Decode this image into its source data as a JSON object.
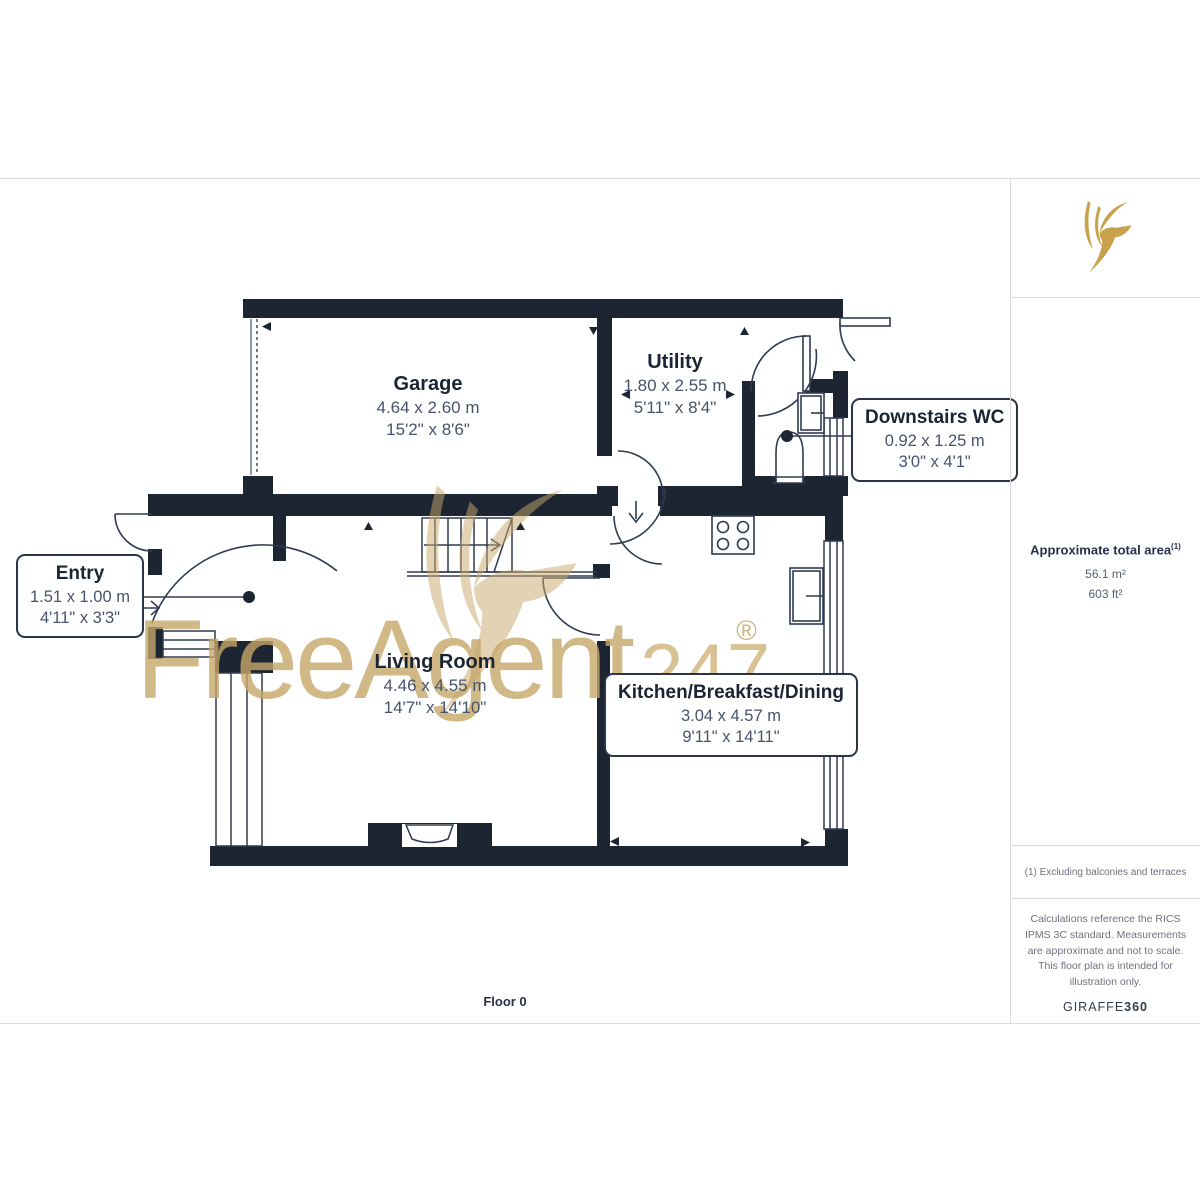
{
  "plan": {
    "floor_label": "Floor 0",
    "colors": {
      "wall": "#1d2533",
      "line": "#2f3b50",
      "room_name_text": "#1b2433",
      "dimension_text": "#46536b"
    }
  },
  "rooms": {
    "garage": {
      "name": "Garage",
      "metric": "4.64 x 2.60 m",
      "imperial": "15'2\" x 8'6\""
    },
    "utility": {
      "name": "Utility",
      "metric": "1.80 x 2.55 m",
      "imperial": "5'11\" x 8'4\""
    },
    "downstairs_wc": {
      "name": "Downstairs WC",
      "metric": "0.92 x 1.25 m",
      "imperial": "3'0\" x 4'1\""
    },
    "entry": {
      "name": "Entry",
      "metric": "1.51 x 1.00 m",
      "imperial": "4'11\" x 3'3\""
    },
    "living_room": {
      "name": "Living Room",
      "metric": "4.46 x 4.55 m",
      "imperial": "14'7\" x 14'10\""
    },
    "kitchen": {
      "name": "Kitchen/Breakfast/Dining",
      "metric": "3.04 x 4.57 m",
      "imperial": "9'11\" x 14'11\""
    }
  },
  "watermark": {
    "brand_main": "FreeAgent",
    "brand_suffix": "247",
    "registered_mark": "®",
    "color_gold": "#c7a55f",
    "icon": "freeagent-bird-watermark"
  },
  "sidebar": {
    "logo_icon": "giraffe360-bird-logo",
    "logo_color": "#c7a14b",
    "area_title": "Approximate total area",
    "area_footnote_marker": "(1)",
    "area_metric": "56.1 m²",
    "area_imperial": "603 ft²",
    "footnote": "(1) Excluding balconies and terraces",
    "disclaimer": "Calculations reference the RICS IPMS 3C standard. Measurements are approximate and not to scale. This floor plan is intended for illustration only.",
    "brand_name": "GIRAFFE",
    "brand_number": "360"
  }
}
